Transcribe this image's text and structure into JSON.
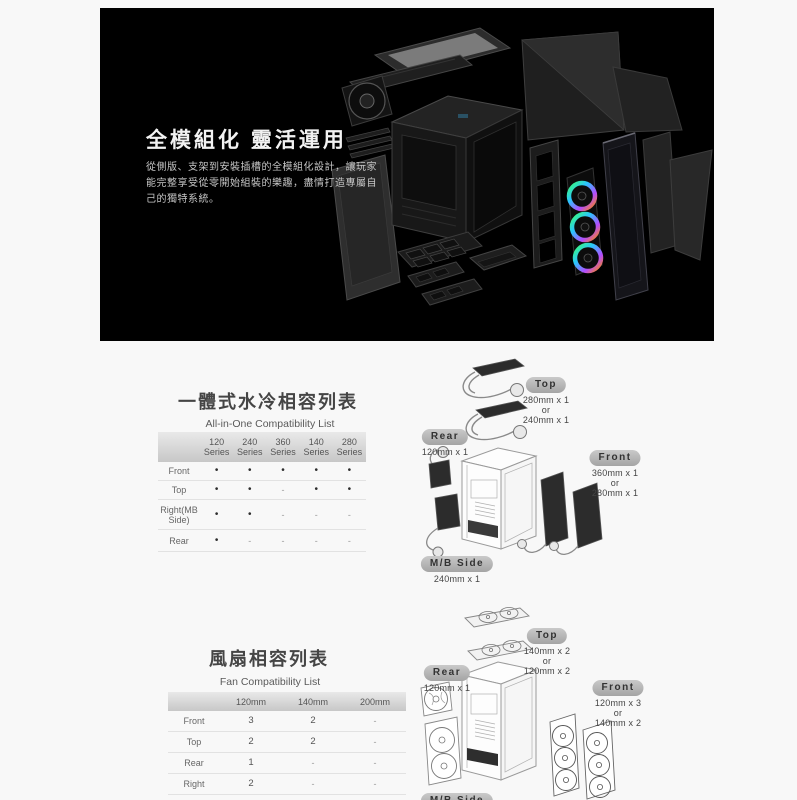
{
  "hero": {
    "title": "全模組化 靈活運用",
    "description": "從側版、支架到安裝插槽的全模組化設計，讓玩家能完整享受從零開始組裝的樂趣，盡情打造專屬自己的獨特系統。"
  },
  "aio": {
    "title": "一體式水冷相容列表",
    "subtitle": "All-in-One Compatibility List",
    "table": {
      "columns": [
        "120 Series",
        "240 Series",
        "360 Series",
        "140 Series",
        "280 Series"
      ],
      "rows": [
        {
          "label": "Front",
          "values": [
            "•",
            "•",
            "•",
            "•",
            "•"
          ]
        },
        {
          "label": "Top",
          "values": [
            "•",
            "•",
            "-",
            "•",
            "•"
          ]
        },
        {
          "label": "Right(MB Side)",
          "values": [
            "•",
            "•",
            "-",
            "-",
            "-"
          ]
        },
        {
          "label": "Rear",
          "values": [
            "•",
            "-",
            "-",
            "-",
            "-"
          ]
        }
      ]
    },
    "labels": {
      "top": {
        "badge": "Top",
        "lines": [
          "280mm x 1",
          "or",
          "240mm x 1"
        ]
      },
      "rear": {
        "badge": "Rear",
        "lines": [
          "120mm x 1"
        ]
      },
      "front": {
        "badge": "Front",
        "lines": [
          "360mm x 1",
          "or",
          "280mm x 1"
        ]
      },
      "mb_side": {
        "badge": "M/B Side",
        "lines": [
          "240mm x 1"
        ]
      }
    }
  },
  "fan": {
    "title": "風扇相容列表",
    "subtitle": "Fan Compatibility List",
    "table": {
      "columns": [
        "120mm",
        "140mm",
        "200mm"
      ],
      "rows": [
        {
          "label": "Front",
          "values": [
            "3",
            "2",
            "-"
          ]
        },
        {
          "label": "Top",
          "values": [
            "2",
            "2",
            "-"
          ]
        },
        {
          "label": "Rear",
          "values": [
            "1",
            "-",
            "-"
          ]
        },
        {
          "label": "Right",
          "values": [
            "2",
            "-",
            "-"
          ]
        }
      ]
    },
    "labels": {
      "top": {
        "badge": "Top",
        "lines": [
          "140mm x 2",
          "or",
          "120mm x 2"
        ]
      },
      "rear": {
        "badge": "Rear",
        "lines": [
          "120mm x 1"
        ]
      },
      "front": {
        "badge": "Front",
        "lines": [
          "120mm x 3",
          "or",
          "140mm x 2"
        ]
      },
      "mb_side": {
        "badge": "M/B Side",
        "lines": []
      }
    }
  },
  "colors": {
    "hero_background": "#000000",
    "badge_background": "#b5b5b5",
    "rgb_fan_gradient": [
      "#39ff6e",
      "#29c5ff",
      "#b44bff",
      "#ff8a00"
    ]
  }
}
